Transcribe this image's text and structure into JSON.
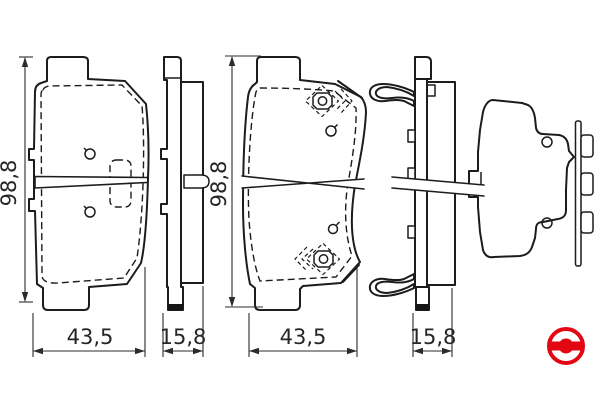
{
  "dimensions": {
    "pad_height_mm": "98,8",
    "pad_width_mm": "43,5",
    "pad_thickness_mm": "15,8"
  },
  "logo": {
    "name": "bosch-armature-logo",
    "color": "#e30613"
  },
  "colors": {
    "background": "#ffffff",
    "line": "#1c1c1c",
    "dimension_text": "#262626"
  }
}
